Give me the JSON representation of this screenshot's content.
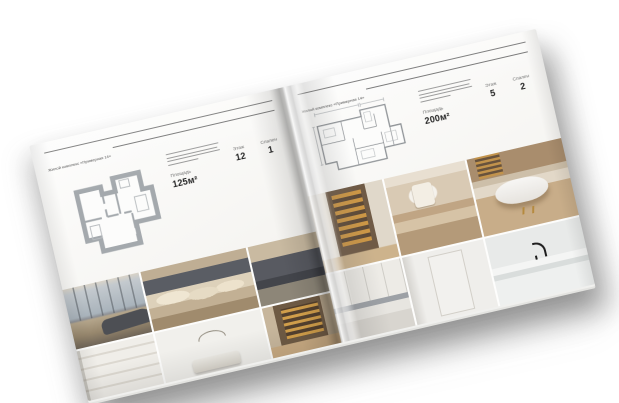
{
  "scene": {
    "background": "#ffffff",
    "subject": "open interior-design brochure mockup"
  },
  "book": {
    "pages": [
      {
        "id": "left",
        "header": "Жилой комплекс «Примерная 14»",
        "specs": [
          {
            "label": "Площадь",
            "value": "125м²"
          },
          {
            "label": "Этаж",
            "value": "12"
          },
          {
            "label": "Спален",
            "value": "1"
          }
        ],
        "floor_plan": "apartment-floor-plan-thick-walls",
        "photos": [
          "living-room-panoramic-windows",
          "bedroom-beige-pillows",
          "bedroom-dark-headboard",
          "white-closet-shelves",
          "white-bedroom-arch-decor",
          "hallway-wine-display"
        ]
      },
      {
        "id": "right",
        "header": "Жилой комплекс «Примерная 14»",
        "specs": [
          {
            "label": "Площадь",
            "value": "200м²"
          },
          {
            "label": "Этаж",
            "value": "5"
          },
          {
            "label": "Спален",
            "value": "2"
          }
        ],
        "floor_plan": "apartment-floor-plan-thin-lines",
        "photos": [
          "wine-cellar-lit-shelves",
          "vanity-room-mirror",
          "bathroom-freestanding-tub",
          "white-kitchen-counter",
          "white-bathroom-door",
          "marble-vanity-black-faucet"
        ]
      }
    ],
    "colors": {
      "page": "#f7f6f3",
      "rule": "#6b6b6b",
      "plan_stroke_left": "#a4a9ad",
      "plan_stroke_right": "#8e9296",
      "spec_label": "#6e6e6e",
      "spec_value": "#232323",
      "wood_accent": "#b58a3e",
      "wine_amber": "#d2a24b"
    }
  }
}
